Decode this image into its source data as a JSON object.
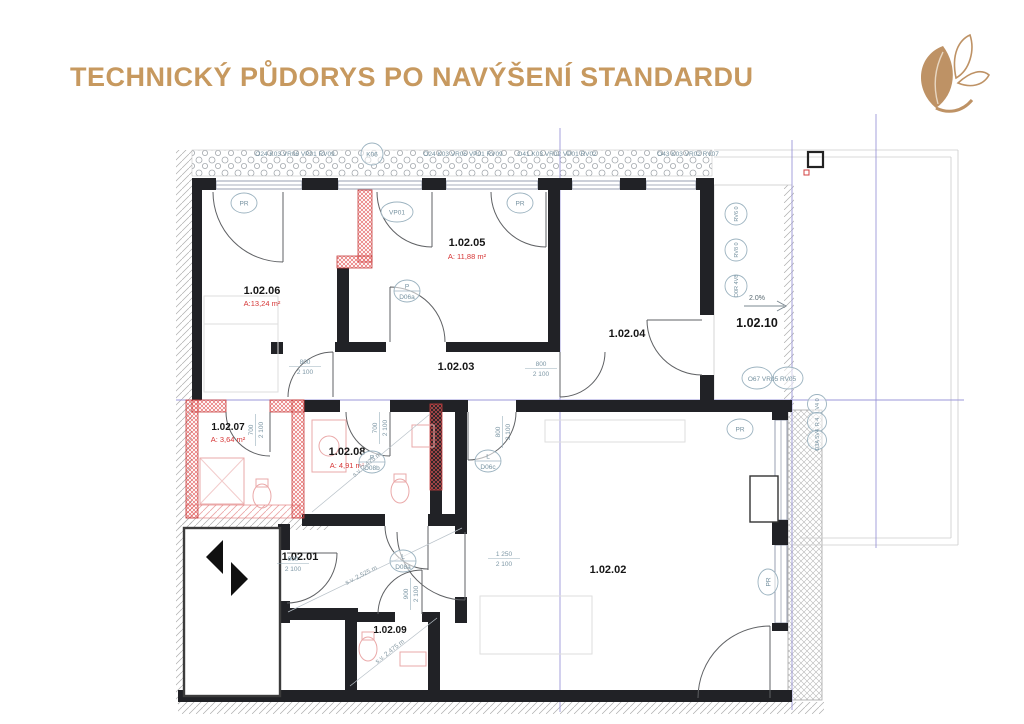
{
  "header": {
    "title": "TECHNICKÝ PŮDORYS PO NAVÝŠENÍ STANDARDU"
  },
  "plan": {
    "top_codes": [
      "O24 K03 VR06 VP01 RV09",
      "K06",
      "O24 K03 VR06 VP01 RV09",
      "O41 K03 VR02 VP01 RV02",
      "O43 K03 VR02 RV07"
    ],
    "rooms": [
      {
        "id": "1.02.06",
        "area": "A:13,24 m²"
      },
      {
        "id": "1.02.05",
        "area": "A: 11,88 m²"
      },
      {
        "id": "1.02.04"
      },
      {
        "id": "1.02.10"
      },
      {
        "id": "1.02.03"
      },
      {
        "id": "1.02.07",
        "area": "A: 3,64 m²"
      },
      {
        "id": "1.02.08",
        "area": "A: 4,91 m²"
      },
      {
        "id": "1.02.01"
      },
      {
        "id": "1.02.02"
      },
      {
        "id": "1.02.09"
      }
    ],
    "tags": {
      "pr": "PR",
      "vp01": "VP01"
    },
    "door_tags": [
      {
        "t": "P",
        "b": "D06a"
      },
      {
        "t": "P",
        "b": "D08b"
      },
      {
        "t": "L",
        "b": "D06c"
      },
      {
        "t": "L",
        "b": "D08a"
      }
    ],
    "dims": {
      "w800": "800",
      "w900": "900",
      "w700": "700",
      "w1250": "1 250",
      "h2100": "2 100"
    },
    "heights": {
      "a": "s.v. 2,475 m",
      "b": "s.v. 2,525 m"
    },
    "slope": "2.0%",
    "right_codes": {
      "group": "O67 VR05 RV05",
      "c1": "RV6 0",
      "c2": "RV8 0",
      "c3": "O0R 4V8",
      "c4": "V4 0",
      "c5": "R 4",
      "c6": "O3A 5V4"
    }
  }
}
